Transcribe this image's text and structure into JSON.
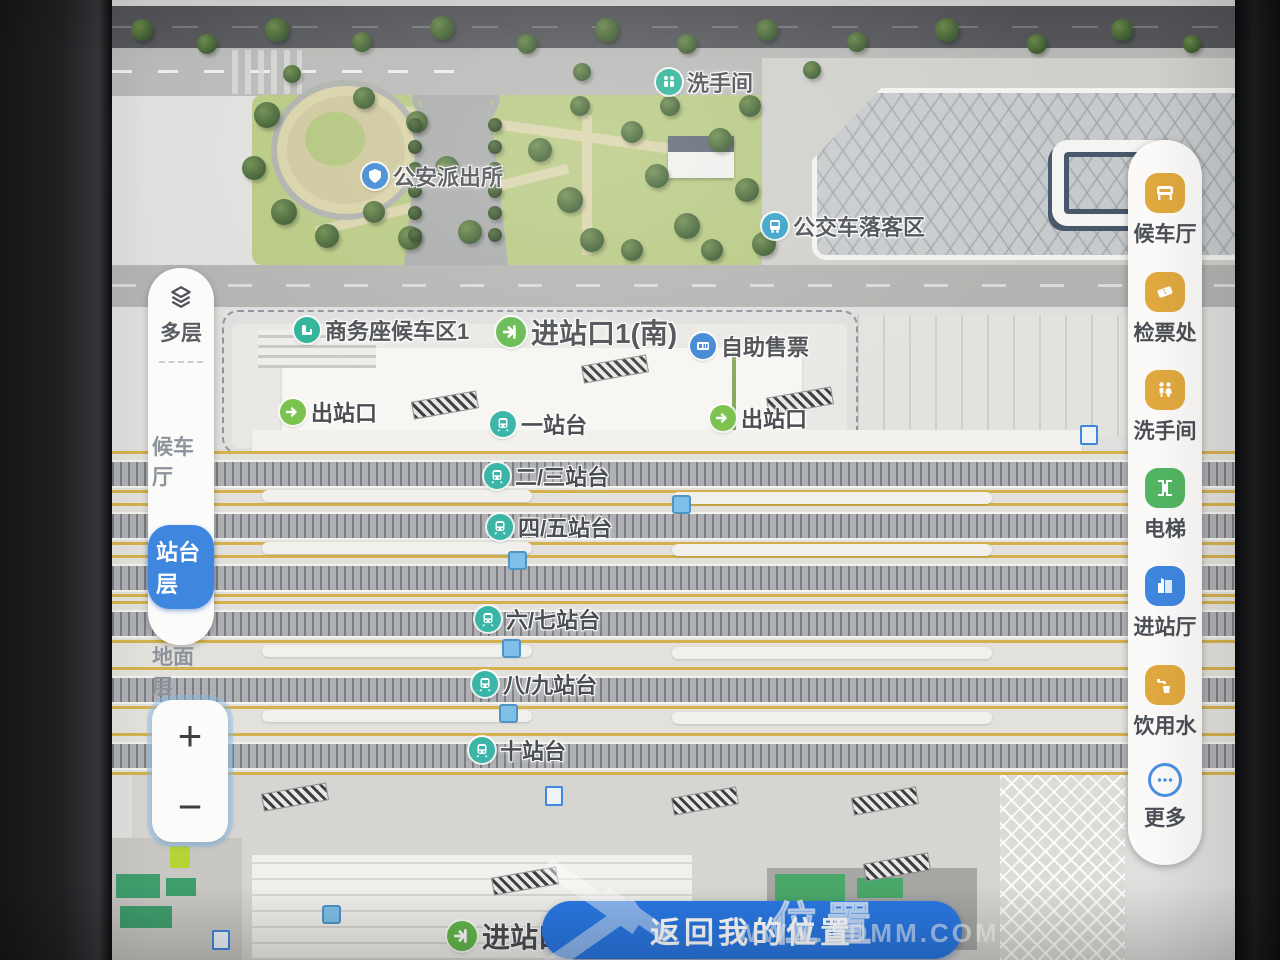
{
  "colors": {
    "accent_blue": "#2a78e3",
    "selected_floor_blue": "#3f86df",
    "poi_teal": "#2eb398",
    "poi_green": "#64b94d",
    "poi_blue": "#3e86d3",
    "poi_cyan": "#35a0c6",
    "facility_gold": "#e0a83e",
    "facility_green": "#52b561",
    "facility_blue": "#3f86df",
    "platform_edge_yellow": "#d4b14e"
  },
  "left_panel": {
    "layers_label": "多层",
    "floors": [
      {
        "label": "候车厅",
        "selected": false
      },
      {
        "label": "站台层",
        "selected": true
      },
      {
        "label": "地面层",
        "selected": false
      }
    ],
    "zoom_in_label": "+",
    "zoom_out_label": "−"
  },
  "right_panel": {
    "items": [
      {
        "label": "候车厅",
        "icon": "waiting-hall-icon",
        "color": "#e0a83e"
      },
      {
        "label": "检票处",
        "icon": "ticket-check-icon",
        "color": "#e0a83e"
      },
      {
        "label": "洗手间",
        "icon": "restroom-icon",
        "color": "#e0a83e"
      },
      {
        "label": "电梯",
        "icon": "elevator-icon",
        "color": "#52b561"
      },
      {
        "label": "进站厅",
        "icon": "entrance-hall-icon",
        "color": "#3f86df"
      },
      {
        "label": "饮用水",
        "icon": "drinking-water-icon",
        "color": "#e0a83e"
      },
      {
        "label": "更多",
        "icon": "more-icon",
        "color": "#4a90e2"
      }
    ]
  },
  "map": {
    "pois": {
      "restroom_top": "洗手间",
      "police": "公安派出所",
      "bus_dropoff": "公交车落客区",
      "business_waiting": "商务座候车区1",
      "entrance1_south": "进站口1(南)",
      "self_ticketing": "自助售票",
      "exit_left": "出站口",
      "exit_right": "出站口",
      "entrance_bottom": "进站口"
    },
    "platforms": [
      "一站台",
      "二/三站台",
      "四/五站台",
      "六/七站台",
      "八/九站台",
      "十站台"
    ]
  },
  "return_button_label": "返回我的位置",
  "watermark": {
    "cn": "位置",
    "url": "WWW.GDMM.COM"
  }
}
